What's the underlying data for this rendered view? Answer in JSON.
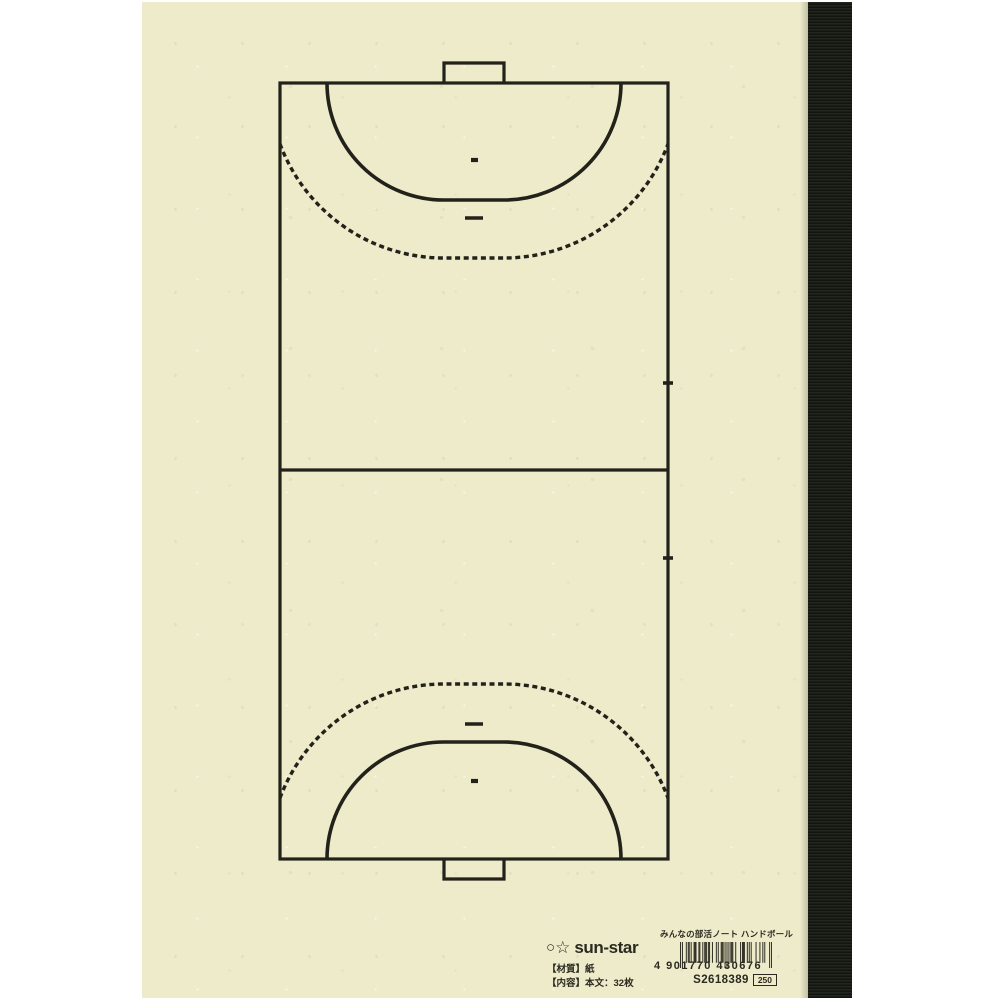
{
  "colors": {
    "background": "#ffffff",
    "paper": "#edebca",
    "court_line": "#22211a",
    "binding": "#161a12",
    "ink": "#2b2a20",
    "barcode_bar": "#343227"
  },
  "court": {
    "sport": "handball",
    "elements": [
      "court-boundary",
      "center-line",
      "goal-boxes",
      "goal-area-6m-lines",
      "free-throw-9m-dashed-lines",
      "penalty-7m-marks",
      "goalkeeper-4m-marks",
      "substitution-line-ticks"
    ]
  },
  "footer": {
    "brand": {
      "circle_icon": "○",
      "star_icon": "☆",
      "logotype": "sun-star"
    },
    "material_line": "【材質】紙",
    "contents_line": "【内容】本文：32枚",
    "product_title": "みんなの部活ノート ハンドボール",
    "barcode": {
      "ean13": "4901770430676",
      "display": "4 901770 430676"
    },
    "product_code": "S2618389",
    "price_code": "250"
  }
}
